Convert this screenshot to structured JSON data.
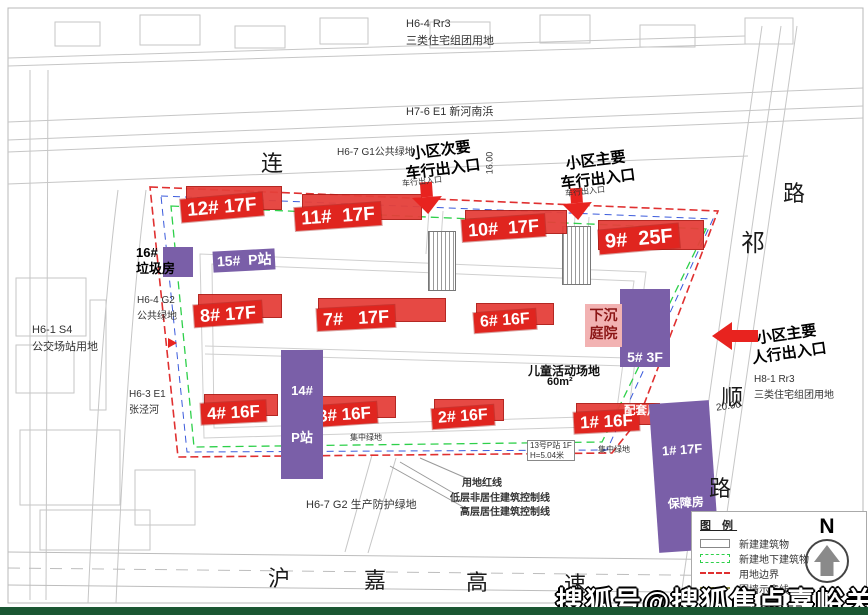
{
  "page": {
    "watermark": "搜狐号@搜狐焦点嘉峪关站"
  },
  "site": {
    "buildings_red": [
      {
        "label": "12# 17F"
      },
      {
        "label": "11#  17F"
      },
      {
        "label": "10#  17F"
      },
      {
        "label": "9#  25F"
      },
      {
        "label": "8# 17F"
      },
      {
        "label": "7#   17F"
      },
      {
        "label": "6# 16F"
      },
      {
        "label": "4# 16F"
      },
      {
        "label": "3# 16F"
      },
      {
        "label": "2# 16F"
      },
      {
        "label": "1# 16F"
      }
    ],
    "facilities": [
      {
        "line1": "15#  P站",
        "line2": ""
      },
      {
        "line1": "14#",
        "line2": "P站"
      },
      {
        "line1": "5# 3F",
        "line2": "配套用房"
      },
      {
        "line1": "1# 17F",
        "line2": "保障房"
      }
    ],
    "courtyard": {
      "line1": "下沉",
      "line2": "庭院"
    },
    "trash_house": {
      "line1": "16#",
      "line2": "垃圾房"
    },
    "playground": {
      "line1": "儿童活动场地",
      "line2": "60m²"
    },
    "p_station_note": {
      "line1": "13号P站 1F",
      "line2": "H=5.04米"
    },
    "green_notes": [
      "集中绿地",
      "集中绿地"
    ],
    "small_entry_notes": [
      "车行出入口",
      "车行出入口"
    ]
  },
  "entrances": [
    {
      "line1": "小区次要",
      "line2": "车行出入口"
    },
    {
      "line1": "小区主要",
      "line2": "车行出入口"
    },
    {
      "line1": "小区主要",
      "line2": "人行出入口"
    }
  ],
  "parcels": [
    {
      "line1": "H6-4 Rr3",
      "line2": "三类住宅组团用地"
    },
    {
      "line1": "H7-6 E1 新河南浜",
      "line2": ""
    },
    {
      "line1": "H6-7 G1公共绿地",
      "line2": ""
    },
    {
      "line1": "H6-1 S4",
      "line2": "公交场站用地"
    },
    {
      "line1": "H6-4 G2",
      "line2": "公共绿地"
    },
    {
      "line1": "H6-3 E1",
      "line2": "张泾河"
    },
    {
      "line1": "H6-7 G2 生产防护绿地",
      "line2": ""
    },
    {
      "line1": "H8-1 Rr3",
      "line2": "三类住宅组团用地"
    }
  ],
  "control_lines": [
    "用地红线",
    "低层非居住建筑控制线",
    "高层居住建筑控制线"
  ],
  "roads": [
    "连",
    "路",
    "祁",
    "顺",
    "路",
    "沪",
    "嘉",
    "高",
    "速"
  ],
  "dimensions": [
    "16.00",
    "20.00"
  ],
  "legend": {
    "title": "图 例",
    "items": [
      "新建建筑物",
      "新建地下建筑物",
      "用地边界",
      "围墙示意线"
    ],
    "north_label": "N"
  },
  "colors": {
    "building_red": "#e0251f",
    "facility_purple": "#7a5fa8",
    "courtyard_pink": "#f2b2b2",
    "boundary_red": "#e03030",
    "underground_green": "#2ed04a",
    "control_blue": "#3b5bdc",
    "bottom_bar_green": "#1a5632"
  }
}
